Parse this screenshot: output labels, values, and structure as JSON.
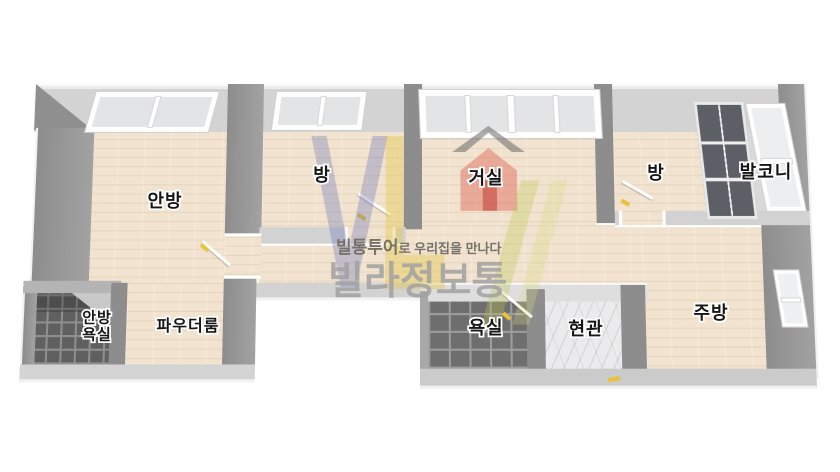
{
  "watermark": {
    "tagline_brand": "빌통투어",
    "tagline_rest": "로 우리집을 만나다",
    "brand_large": "빌라정보통",
    "logo_colors": {
      "v_blue": "#5868ba",
      "l_yellow": "#e6c43c",
      "house_red": "#e06a5c",
      "slash_green": "#bec850"
    }
  },
  "rooms": [
    {
      "id": "anbang",
      "label": "안방"
    },
    {
      "id": "bang-front",
      "label": "방"
    },
    {
      "id": "geosil",
      "label": "거실"
    },
    {
      "id": "bang-rear",
      "label": "방"
    },
    {
      "id": "balkoni",
      "label": "발코니"
    },
    {
      "id": "anbang-yoksil",
      "label": "안방 욕실",
      "line1": "안방",
      "line2": "욕실"
    },
    {
      "id": "paudeoreum",
      "label": "파우더룸"
    },
    {
      "id": "yoksil",
      "label": "욕실"
    },
    {
      "id": "hyeongwan",
      "label": "현관"
    },
    {
      "id": "jubang",
      "label": "주방"
    }
  ],
  "palette": {
    "wood_floor": "#f1e3cf",
    "wall_light": "#d3d3d3",
    "wall_dark": "#9a9a9a",
    "bath_tile": "#6e6e6e",
    "marble": "#ebebed",
    "balcony_floor": "#d9d9d9",
    "window_glass": "#e2e4e6",
    "dark_window": "#5c6066",
    "door_marker_yellow": "#e8c23c",
    "label_text": "#161616",
    "watermark_text": "#a2a2a2"
  }
}
